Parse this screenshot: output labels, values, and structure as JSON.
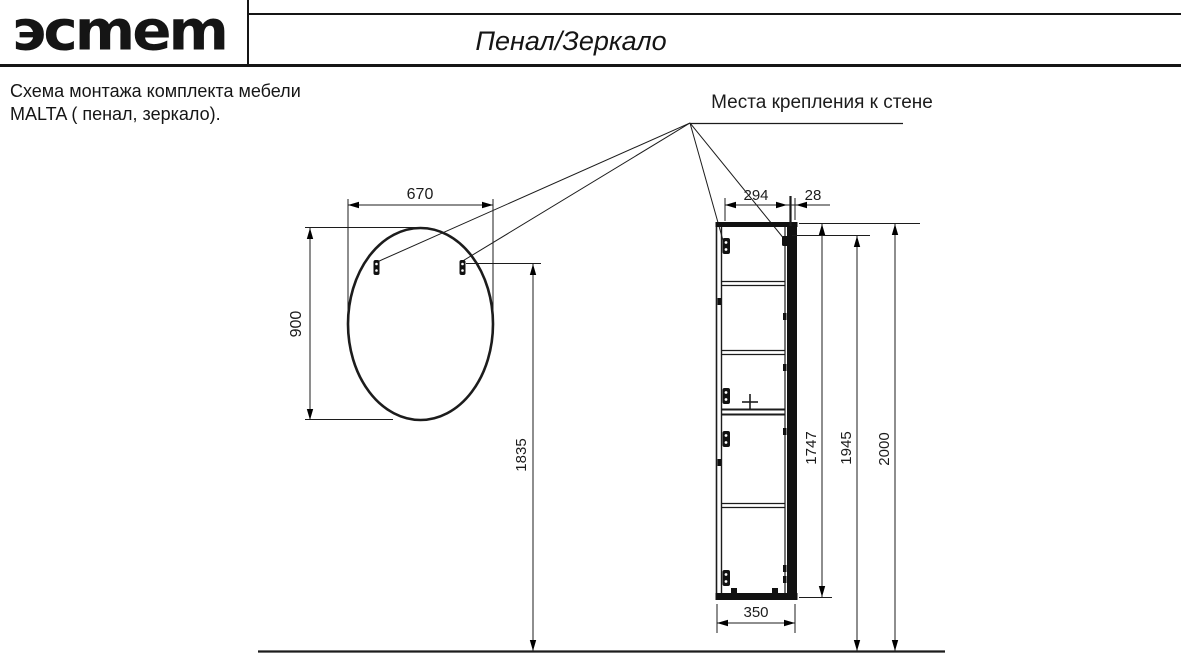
{
  "header": {
    "logo": "эcmem",
    "title": "Пенал/Зеркало"
  },
  "note": {
    "line1": "Схема монтажа комплекта мебели",
    "line2": "MALTA  ( пенал, зеркало)."
  },
  "annotation": {
    "wall_mount_label": "Места крепления к стене"
  },
  "dimensions": {
    "mirror_width": "670",
    "mirror_height": "900",
    "mirror_mount_height": "1835",
    "cabinet_top_depth": "294",
    "cabinet_door_offset": "28",
    "cabinet_height": "1747",
    "cabinet_mount_height": "1945",
    "cabinet_total_height": "2000",
    "cabinet_depth": "350"
  },
  "colors": {
    "line": "#1c1c1c",
    "accent_teal": "#4a7586"
  }
}
